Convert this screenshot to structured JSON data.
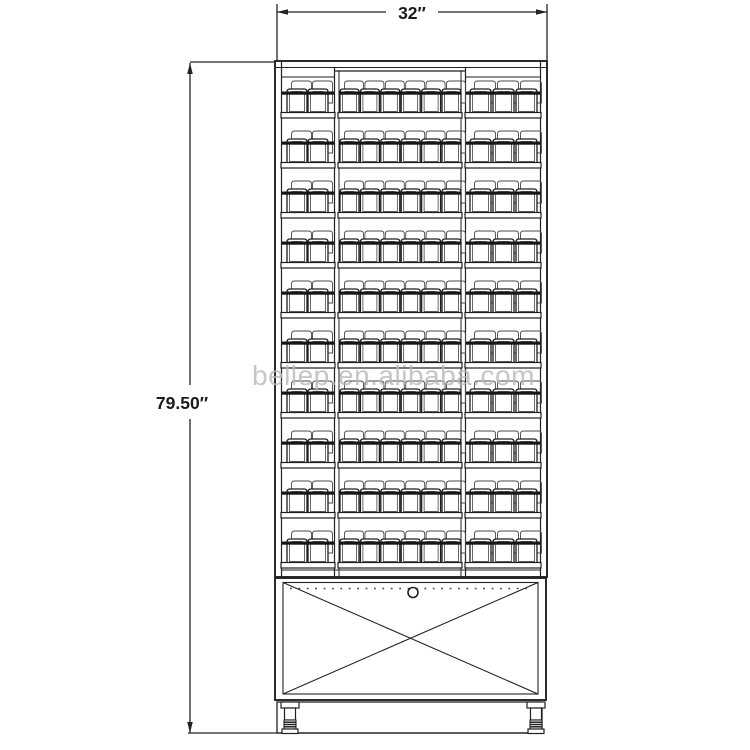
{
  "drawing": {
    "width_dimension_label": "32″",
    "height_dimension_label": "79.50″",
    "line_color": "#222222",
    "background": "#ffffff"
  },
  "watermark": {
    "text": "bellep.en.alibaba.com",
    "color": "#b8b8b8"
  },
  "structure": {
    "shelf_rows": 10,
    "columns": [
      {
        "name": "left",
        "front_packs": 2
      },
      {
        "name": "center",
        "front_packs": 6
      },
      {
        "name": "right",
        "front_packs": 3
      }
    ]
  }
}
